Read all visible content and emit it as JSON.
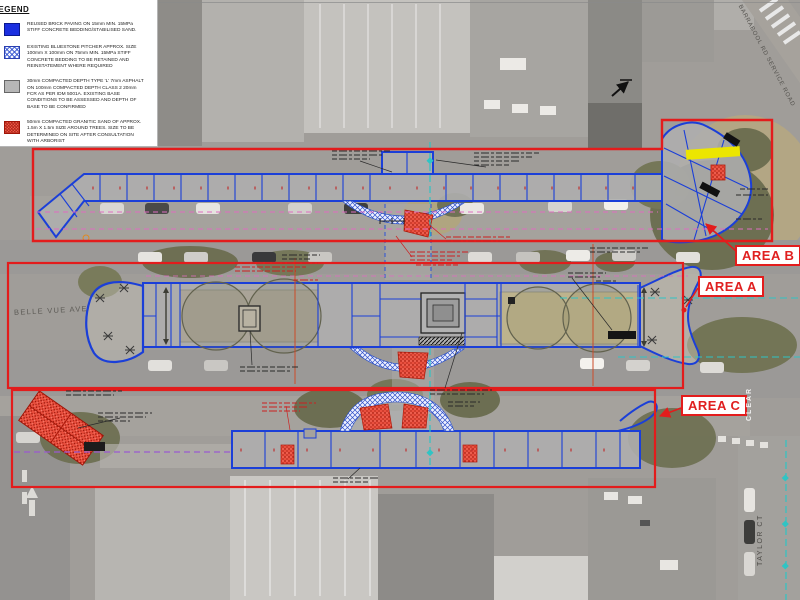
{
  "legend": {
    "title": "LEGEND",
    "items": [
      {
        "swatch": "brick-blue",
        "text": "REUSED BRICK PAVING ON 15mm MIN. 15MPa STIFF CONCRETE BEDDING/STABILISED SAND."
      },
      {
        "swatch": "bluestone-hatch",
        "text": "EXISTING BLUESTONE PITCHER APPROX. SIZE 100mm X 100mm ON 75mm MIN. 15MPa STIFF CONCRETE BEDDING TO BE RETAINED AND REINSTATEMENT WHERE REQUIRED"
      },
      {
        "swatch": "asphalt-gray",
        "text": "30mm COMPACTED DEPTH TYPE 'L' 7mm ASPHALT ON 100mm COMPACTED DEPTH CLASS 2 20mm FCR AS PER IDM 5001A. EXISTING BASE CONDITIONS TO BE ASSESSED AND DEPTH OF BASE TO BE CONFIRMED"
      },
      {
        "swatch": "granitic-sand-red",
        "text": "50mm COMPACTED GRANITIC SAND OF APPROX. 1.5m X 1.5m SIZE AROUND TREES. SIZE TO BE DETERMINED ON SITE AFTER CONSULTATION WITH ARBORIST"
      }
    ]
  },
  "areas": {
    "a": "AREA A",
    "b": "AREA B",
    "c": "AREA C"
  },
  "streets": {
    "belle_vue": "BELLE VUE AVE",
    "barrabool": "BARRABOOL RD SERVICE ROAD",
    "taylor": "TAYLOR CT"
  },
  "road_markings": {
    "clear": "CLEAR"
  },
  "colors": {
    "plan_blue": "#1b3fd8",
    "area_boundary_red": "#e31c1c",
    "granitic_sand_red": "#ea4f3e",
    "highlight_yellow": "#ece600",
    "bluestone_hatch_blue": "#3050c8",
    "magenta_dashed": "#de6cc0",
    "cyan_dashed": "#2fc4c4",
    "asphalt_gray": "#b6b6b6",
    "brick_blue": "#1b2fe0"
  }
}
